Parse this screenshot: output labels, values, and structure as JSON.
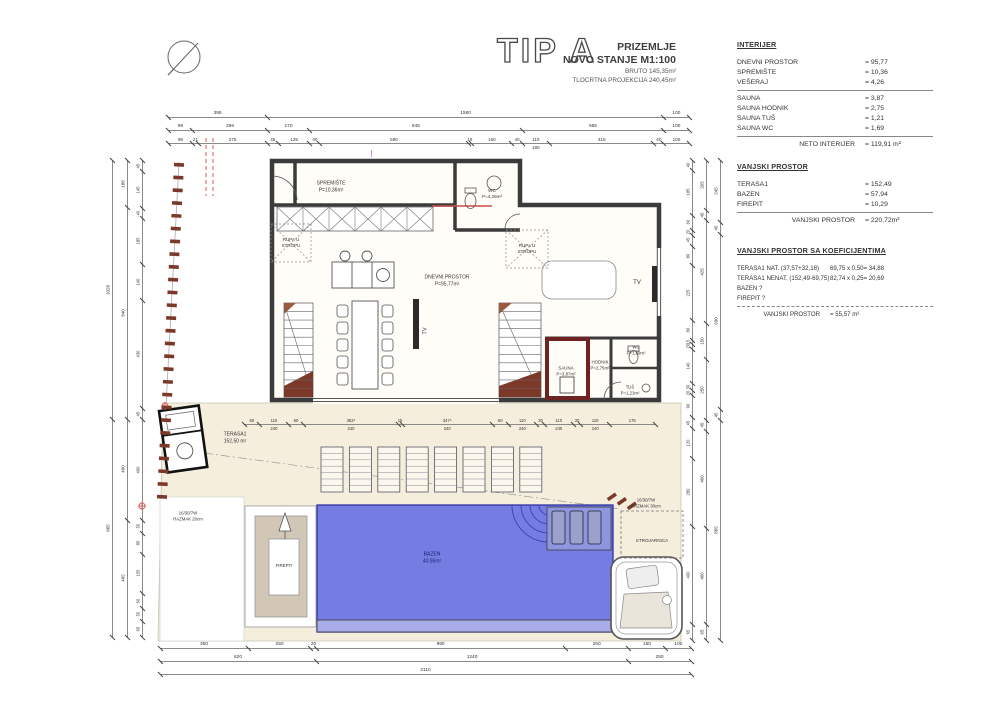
{
  "title": {
    "type_label": "TIP A",
    "floor": "PRIZEMLJE",
    "state": "NOVO STANJE M1:100",
    "bruto": "BRUTO 145,35m²",
    "projection": "TLOCRTNA PROJEKCIJA 240,45m²"
  },
  "colors": {
    "pool_blue": "#767de2",
    "terrace_cream": "#f5eedd",
    "sauna_wall_red": "#6e2222",
    "boundary_brown": "#7c392a",
    "reference_red": "#e05555",
    "section_magenta": "#d24fc4"
  },
  "tables": [
    {
      "id": "interijer",
      "header": "INTERIJER",
      "val_x": 128,
      "rows": [
        {
          "label": "DNEVNI PROSTOR",
          "value": "= 95,77"
        },
        {
          "label": "SPREMIŠTE",
          "value": "= 10,36"
        },
        {
          "label": "VEŠERAJ",
          "value": "= 4,26"
        },
        {
          "sep": true
        },
        {
          "label": "SAUNA",
          "value": "= 3,87"
        },
        {
          "label": "SAUNA HODNIK",
          "value": "= 2,75"
        },
        {
          "label": "SAUNA TUŠ",
          "value": "= 1,21"
        },
        {
          "label": "SAUNA WC",
          "value": "= 1,69"
        },
        {
          "sep": true
        },
        {
          "label": "NETO INTERIJER",
          "value": "= 119,91 m²",
          "total": true
        }
      ]
    },
    {
      "id": "vanjski",
      "header": "VANJSKI PROSTOR",
      "val_x": 128,
      "rows": [
        {
          "label": "TERASA1",
          "value": "= 152,49"
        },
        {
          "label": "BAZEN",
          "value": "= 57,94"
        },
        {
          "label": "FIREPIT",
          "value": "= 10,29"
        },
        {
          "sep": true
        },
        {
          "label": "VANJSKI PROSTOR",
          "value": "= 220,72m²",
          "total": true
        }
      ]
    },
    {
      "id": "koeficijenti",
      "header": "VANJSKI PROSTOR SA KOEFICIJENTIMA",
      "val_x": 93,
      "rows": [
        {
          "label": "TERASA1 NAT. (37,57+32,18)",
          "value": "69,75 x 0,50= 34,88"
        },
        {
          "label": "TERASA1 NENAT. (152,49-69,75)",
          "value": "82,74 x 0,25= 20,69"
        },
        {
          "label": "BAZEN ?",
          "value": ""
        },
        {
          "label": "FIREPIT ?",
          "value": ""
        },
        {
          "sep": true
        },
        {
          "label": "VANJSKI PROSTOR",
          "value": "= 55,57 m²",
          "total": true
        }
      ]
    }
  ],
  "plan_labels": [
    {
      "name": "label-spremiste",
      "x": 331,
      "y": 187,
      "size": 5,
      "lines": [
        "SPREMIŠTE",
        "P=10,36m²"
      ]
    },
    {
      "name": "label-wc-top",
      "x": 492,
      "y": 194,
      "size": 4.6,
      "lines": [
        "WC",
        "P=4,26m²"
      ]
    },
    {
      "name": "label-dnevni-prostor",
      "x": 447,
      "y": 281,
      "size": 5,
      "lines": [
        "DNEVNI PROSTOR",
        "P=95,77m²"
      ]
    },
    {
      "name": "label-rupa-u-stropu-left",
      "x": 291,
      "y": 243,
      "size": 4.5,
      "lines": [
        "RUPA U",
        "STROPU"
      ]
    },
    {
      "name": "label-rupa-u-stropu-right",
      "x": 527,
      "y": 249,
      "size": 4.5,
      "lines": [
        "RUPA U",
        "STROPU"
      ]
    },
    {
      "name": "label-tv-middle",
      "x": 426,
      "y": 331,
      "size": 5.5,
      "rot": -90,
      "lines": [
        "TV"
      ]
    },
    {
      "name": "label-tv-right",
      "x": 637,
      "y": 284,
      "size": 6,
      "lines": [
        "TV"
      ]
    },
    {
      "name": "label-sauna",
      "x": 566,
      "y": 371,
      "size": 4.4,
      "lines": [
        "SAUNA",
        "P=3,87m²"
      ]
    },
    {
      "name": "label-hodnik",
      "x": 600,
      "y": 365,
      "size": 4.4,
      "lines": [
        "HODNIK",
        "P=2,75m²"
      ]
    },
    {
      "name": "label-sauna-wc",
      "x": 636,
      "y": 350,
      "size": 4.3,
      "lines": [
        "WC",
        "P=1,69m²"
      ]
    },
    {
      "name": "label-tus",
      "x": 630,
      "y": 390,
      "size": 4.3,
      "lines": [
        "TUŠ",
        "P=1,21m²"
      ]
    },
    {
      "name": "label-terasa1",
      "x": 235,
      "y": 438,
      "size": 5,
      "lines": [
        "TERASA1",
        "152,50 m²"
      ]
    },
    {
      "name": "label-firepit",
      "x": 284,
      "y": 566,
      "size": 4.4,
      "lines": [
        "FIREPIT"
      ]
    },
    {
      "name": "label-bazen",
      "x": 432,
      "y": 558,
      "size": 5,
      "color": "#1c1c6e",
      "lines": [
        "BAZEN",
        "40,95m²"
      ]
    },
    {
      "name": "label-strojarnica",
      "x": 652,
      "y": 541,
      "size": 4.6,
      "lines": [
        "STROJARNICA"
      ]
    },
    {
      "name": "label-razmak-left",
      "x": 188,
      "y": 516,
      "size": 4.3,
      "lines": [
        "16/30/7W",
        "RAZMAK 20cm"
      ]
    },
    {
      "name": "label-razmak-right",
      "x": 646,
      "y": 503,
      "size": 4.3,
      "lines": [
        "16/30/7W",
        "RAZMAK 30cm"
      ]
    }
  ],
  "dim_chains": [
    {
      "name": "top-row-1",
      "o": "h",
      "x": 168,
      "y": 117,
      "len": 521,
      "size": 4.8,
      "segs": [
        395,
        1580,
        100
      ]
    },
    {
      "name": "top-row-2",
      "o": "h",
      "x": 168,
      "y": 130,
      "len": 521,
      "size": 4.8,
      "segs": [
        99,
        296,
        170,
        845,
        565,
        100
      ]
    },
    {
      "name": "top-row-3",
      "o": "h",
      "x": 168,
      "y": 143,
      "len": 521,
      "size": 4.6,
      "segs": [
        99,
        21,
        275,
        45,
        125,
        40,
        590,
        15,
        160,
        40,
        {
          "t": "110",
          "n": 110,
          "b": "190"
        },
        415,
        40,
        100
      ]
    },
    {
      "name": "bottom-row-1",
      "o": "h",
      "x": 160,
      "y": 648,
      "len": 531,
      "size": 4.8,
      "segs": [
        350,
        250,
        20,
        990,
        250,
        150,
        100
      ]
    },
    {
      "name": "bottom-row-2",
      "o": "h",
      "x": 160,
      "y": 661,
      "len": 531,
      "size": 4.8,
      "segs": [
        620,
        1240,
        250
      ]
    },
    {
      "name": "bottom-row-3",
      "o": "h",
      "x": 160,
      "y": 674,
      "len": 531,
      "size": 4.8,
      "segs": [
        2110
      ]
    },
    {
      "name": "left-outer",
      "o": "v",
      "x": 112,
      "y": 160,
      "len": 477,
      "size": 4.5,
      "segs": [
        1028,
        865
      ]
    },
    {
      "name": "left-middle",
      "o": "v",
      "x": 127,
      "y": 160,
      "len": 477,
      "size": 4.5,
      "segs": [
        188,
        840,
        400,
        465
      ]
    },
    {
      "name": "left-inner",
      "o": "v",
      "x": 142,
      "y": 160,
      "len": 477,
      "size": 4.2,
      "segs": [
        45,
        145,
        40,
        185,
        140,
        430,
        45,
        400,
        50,
        85,
        155,
        60,
        50,
        65
      ]
    },
    {
      "name": "right-inner",
      "o": "v",
      "x": 692,
      "y": 160,
      "len": 480,
      "size": 4.2,
      "segs": [
        40,
        185,
        60,
        20,
        45,
        80,
        225,
        80,
        15,
        20,
        140,
        30,
        20,
        90,
        45,
        120,
        280,
        400,
        65
      ]
    },
    {
      "name": "right-middle",
      "o": "v",
      "x": 706,
      "y": 160,
      "len": 480,
      "size": 4.4,
      "segs": [
        205,
        45,
        425,
        150,
        250,
        45,
        400,
        400,
        65
      ]
    },
    {
      "name": "right-outer",
      "o": "v",
      "x": 720,
      "y": 160,
      "len": 480,
      "size": 4.5,
      "segs": [
        245,
        45,
        690,
        45,
        865
      ]
    },
    {
      "name": "terrace-middle",
      "o": "h",
      "x": 244,
      "y": 424,
      "len": 411,
      "size": 4.2,
      "segs": [
        60,
        {
          "t": "110",
          "n": 110,
          "b": "240"
        },
        60,
        {
          "t": "362⁵",
          "n": 362.5,
          "b": "240"
        },
        15,
        {
          "t": "347⁵",
          "n": 347.5,
          "b": "240"
        },
        60,
        {
          "t": "110",
          "n": 110,
          "b": "240"
        },
        30,
        {
          "t": "110",
          "n": 110,
          "b": "240"
        },
        30,
        {
          "t": "110",
          "n": 110,
          "b": "240"
        },
        175
      ]
    }
  ]
}
